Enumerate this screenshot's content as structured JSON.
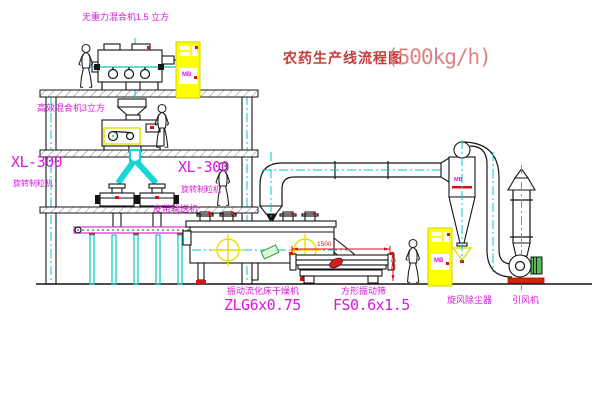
{
  "title": {
    "text": "农药生产线流程图",
    "capacity": "(500kg/h)"
  },
  "equipment_labels": {
    "gravity_free_mixer": "无重力混合机1.5 立方",
    "high_efficiency_mixer": "高效混合机3立方",
    "granulator_left": {
      "model": "XL-300",
      "name": "旋转制粒机"
    },
    "granulator_center": {
      "model": "XL-300",
      "name": "旋转制粒机"
    },
    "belt_conveyor": "皮带输送机",
    "fluid_bed_dryer": {
      "name": "振动流化床干燥机",
      "model": "ZLG6x0.75"
    },
    "vibrating_screen": {
      "name": "方形振动筛",
      "model": "FS0.6x1.5"
    },
    "cyclone": "旋风除尘器",
    "induced_draft_fan": "引风机"
  },
  "annotations": {
    "cabinet_top_text": "MB",
    "cabinet_right_text": "MB",
    "cyclone_tag": "MB",
    "dim_width": "1500",
    "dim_height": "545"
  },
  "colors": {
    "line": "#141414",
    "label_magenta": "#d619d6",
    "title_red": "#c43c3c",
    "capacity_red": "#dd8282",
    "centerline_cyan": "#00c8c8",
    "cabinet_yellow": "#ffff00",
    "detail_red": "#dd1111",
    "detail_green": "#2f9e2f"
  }
}
